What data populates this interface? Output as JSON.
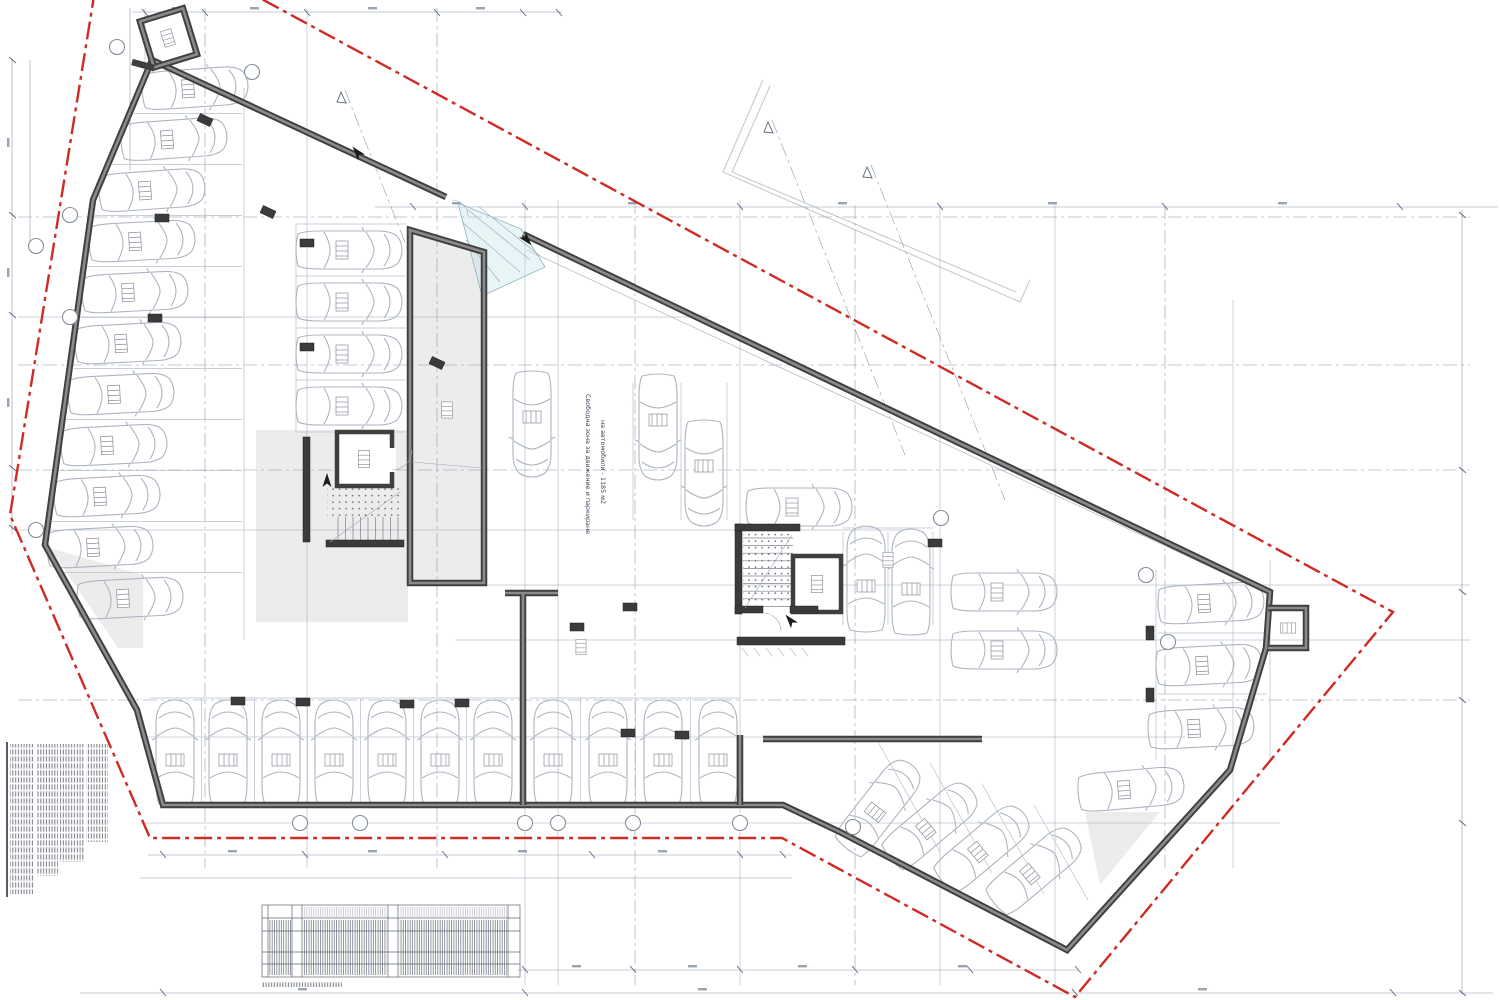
{
  "annotations": {
    "free_zone_line1": "Свободна зона за движение и паркиране",
    "free_zone_line2": "на автомобили - 1185 м2"
  },
  "colors": {
    "background": "#ffffff",
    "boundary_red": "#cf2b24",
    "wall_dark": "#3f3f3f",
    "wall_core_gray": "#8b8b8b",
    "car_outline": "#adb5c0",
    "dimension_blue_gray": "#8e99ac",
    "shade_gray": "#ececec",
    "entrance_cyan": "#bcdce6",
    "label_navy": "#3c4257"
  }
}
